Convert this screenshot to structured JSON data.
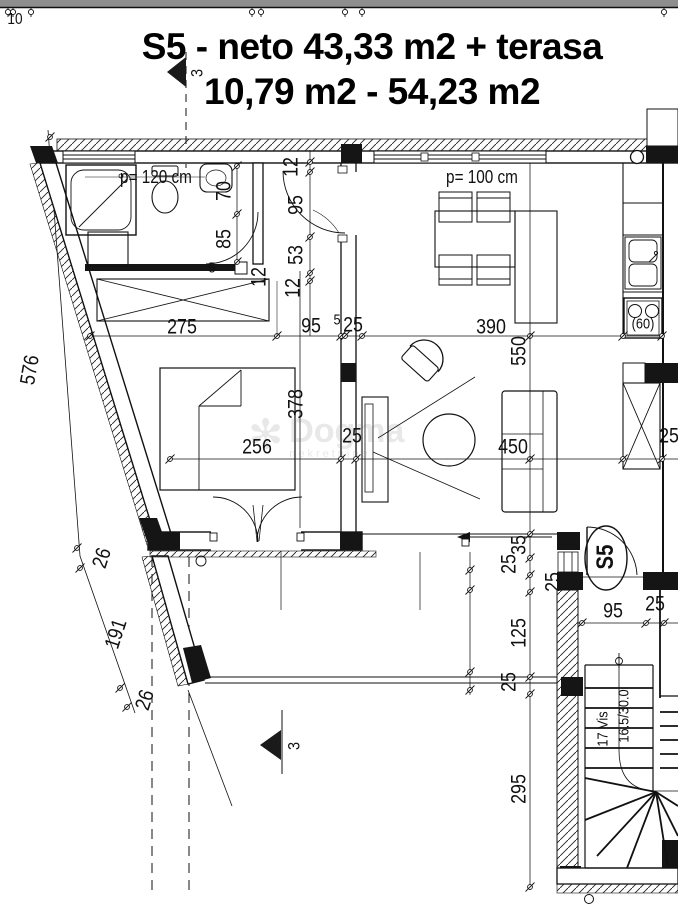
{
  "colors": {
    "line": "#111111",
    "top_bar": "#8e8e8e",
    "paper": "#ffffff"
  },
  "title": {
    "line1": "S5 - neto 43,33 m2 + terasa",
    "line2": "10,79 m2 - 54,23 m2"
  },
  "watermark": {
    "name": "Dogma",
    "subtitle": "nekretnine",
    "flower_icon": "flower-asterisk"
  },
  "labels": [
    {
      "name": "wall-dim-10",
      "text": "10",
      "cx": 15,
      "cy": 20,
      "rot": 0,
      "fs": 16
    },
    {
      "name": "section-marker-top-label",
      "text": "3",
      "cx": 197,
      "cy": 73,
      "rot": -90,
      "fs": 17
    },
    {
      "name": "section-marker-bottom-label",
      "text": "3",
      "cx": 294,
      "cy": 746,
      "rot": -90,
      "fs": 17
    },
    {
      "name": "parapet-height-bathroom",
      "text": "p= 120 cm",
      "cx": 156,
      "cy": 177,
      "rot": 0,
      "fs": 18
    },
    {
      "name": "parapet-height-living",
      "text": "p= 100 cm",
      "cx": 482,
      "cy": 177,
      "rot": 0,
      "fs": 18
    },
    {
      "name": "dim-label",
      "text": "70",
      "cx": 224,
      "cy": 191,
      "rot": -90
    },
    {
      "name": "dim-label",
      "text": "85",
      "cx": 224,
      "cy": 239,
      "rot": -90
    },
    {
      "name": "dim-label",
      "text": "12",
      "cx": 291,
      "cy": 167,
      "rot": -90
    },
    {
      "name": "dim-label",
      "text": "95",
      "cx": 296,
      "cy": 205,
      "rot": -90
    },
    {
      "name": "dim-label",
      "text": "53",
      "cx": 296,
      "cy": 255,
      "rot": -90
    },
    {
      "name": "dim-label",
      "text": "12",
      "cx": 293,
      "cy": 288,
      "rot": -90
    },
    {
      "name": "dim-label",
      "text": "12",
      "cx": 259,
      "cy": 277,
      "rot": -90
    },
    {
      "name": "dim-label",
      "text": "5",
      "cx": 212,
      "cy": 268,
      "rot": 0,
      "fs": 15
    },
    {
      "name": "dim-label",
      "text": "275",
      "cx": 182,
      "cy": 327,
      "rot": 0
    },
    {
      "name": "dim-label",
      "text": "95",
      "cx": 311,
      "cy": 326,
      "rot": 0
    },
    {
      "name": "dim-label",
      "text": "5",
      "cx": 337,
      "cy": 320,
      "rot": 0,
      "fs": 15
    },
    {
      "name": "dim-label",
      "text": "25",
      "cx": 353,
      "cy": 325,
      "rot": 0
    },
    {
      "name": "dim-label",
      "text": "390",
      "cx": 491,
      "cy": 327,
      "rot": 0
    },
    {
      "name": "dim-label",
      "text": "550",
      "cx": 519,
      "cy": 351,
      "rot": -90
    },
    {
      "name": "dim-label",
      "text": "576",
      "cx": 30,
      "cy": 370,
      "rot": -80
    },
    {
      "name": "dim-label",
      "text": "378",
      "cx": 296,
      "cy": 404,
      "rot": -90
    },
    {
      "name": "dim-label",
      "text": "256",
      "cx": 257,
      "cy": 447,
      "rot": 0
    },
    {
      "name": "dim-label",
      "text": "25",
      "cx": 352,
      "cy": 436,
      "rot": 0
    },
    {
      "name": "dim-label",
      "text": "450",
      "cx": 513,
      "cy": 447,
      "rot": 0
    },
    {
      "name": "dim-label",
      "text": "25",
      "cx": 669,
      "cy": 436,
      "rot": 0
    },
    {
      "name": "dim-label",
      "text": "26",
      "cx": 102,
      "cy": 558,
      "rot": -72
    },
    {
      "name": "dim-label",
      "text": "191",
      "cx": 116,
      "cy": 634,
      "rot": -72
    },
    {
      "name": "dim-label",
      "text": "26",
      "cx": 145,
      "cy": 700,
      "rot": -72
    },
    {
      "name": "dim-label",
      "text": "35",
      "cx": 519,
      "cy": 545,
      "rot": -90
    },
    {
      "name": "dim-label",
      "text": "25",
      "cx": 509,
      "cy": 564,
      "rot": -90
    },
    {
      "name": "dim-label",
      "text": "25",
      "cx": 553,
      "cy": 582,
      "rot": -90
    },
    {
      "name": "dim-label",
      "text": "125",
      "cx": 519,
      "cy": 633,
      "rot": -90
    },
    {
      "name": "dim-label",
      "text": "25",
      "cx": 509,
      "cy": 682,
      "rot": -90
    },
    {
      "name": "dim-label",
      "text": "95",
      "cx": 613,
      "cy": 611,
      "rot": 0
    },
    {
      "name": "dim-label",
      "text": "25",
      "cx": 655,
      "cy": 604,
      "rot": 0
    },
    {
      "name": "dim-label",
      "text": "295",
      "cx": 519,
      "cy": 789,
      "rot": -90
    },
    {
      "name": "stove-width-label",
      "text": "(60)",
      "cx": 643,
      "cy": 324,
      "rot": 0,
      "fs": 15
    },
    {
      "name": "unit-number-label",
      "text": "S5",
      "cx": 606,
      "cy": 557,
      "rot": -90,
      "fs": 24,
      "bold": true
    },
    {
      "name": "stair-risers-label",
      "text": "17 Vis",
      "cx": 603,
      "cy": 729,
      "rot": -90,
      "fs": 15
    },
    {
      "name": "stair-step-dims-label",
      "text": "16.5/30.0",
      "cx": 624,
      "cy": 716,
      "rot": -90,
      "fs": 15
    }
  ]
}
